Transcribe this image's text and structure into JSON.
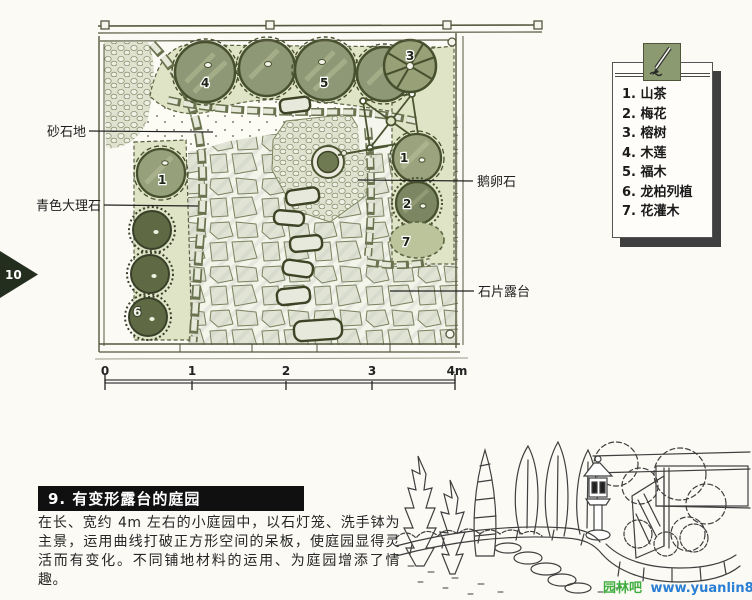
{
  "page": {
    "marker": "10"
  },
  "legend": {
    "items": [
      "1. 山茶",
      "2. 梅花",
      "3. 榕树",
      "4. 木莲",
      "5. 福木",
      "6. 龙柏列植",
      "7. 花灌木"
    ]
  },
  "plan": {
    "labels": {
      "sand": "砂石地",
      "marble": "青色大理石",
      "pebble": "鹅卵石",
      "terrace": "石片露台"
    },
    "tree_numbers": {
      "t1_left": "1",
      "t1_right": "1",
      "t2": "2",
      "t3": "3",
      "t4": "4",
      "t5": "5",
      "t6": "6",
      "t7": "7"
    }
  },
  "scale": {
    "ticks": [
      "0",
      "1",
      "2",
      "3",
      "4m"
    ]
  },
  "section": {
    "title": "9. 有变形露台的庭园",
    "body": "在长、宽约 4m 左右的小庭园中，以石灯笼、洗手钵为主景，运用曲线打破正方形空间的呆板，使庭园显得灵活而有变化。不同铺地材料的运用、为庭园增添了情趣。"
  },
  "watermark": {
    "site_name": "园林吧",
    "site_url": "www.yuanlin8.com"
  },
  "colors": {
    "legend_tab_green": "#8b9a70",
    "title_bar_bg": "#101010",
    "watermark_green": "#3fae3f",
    "watermark_blue": "#2b7fd4",
    "canopy_olive": "#8e9876",
    "dark_juniper": "#5f6a44"
  }
}
